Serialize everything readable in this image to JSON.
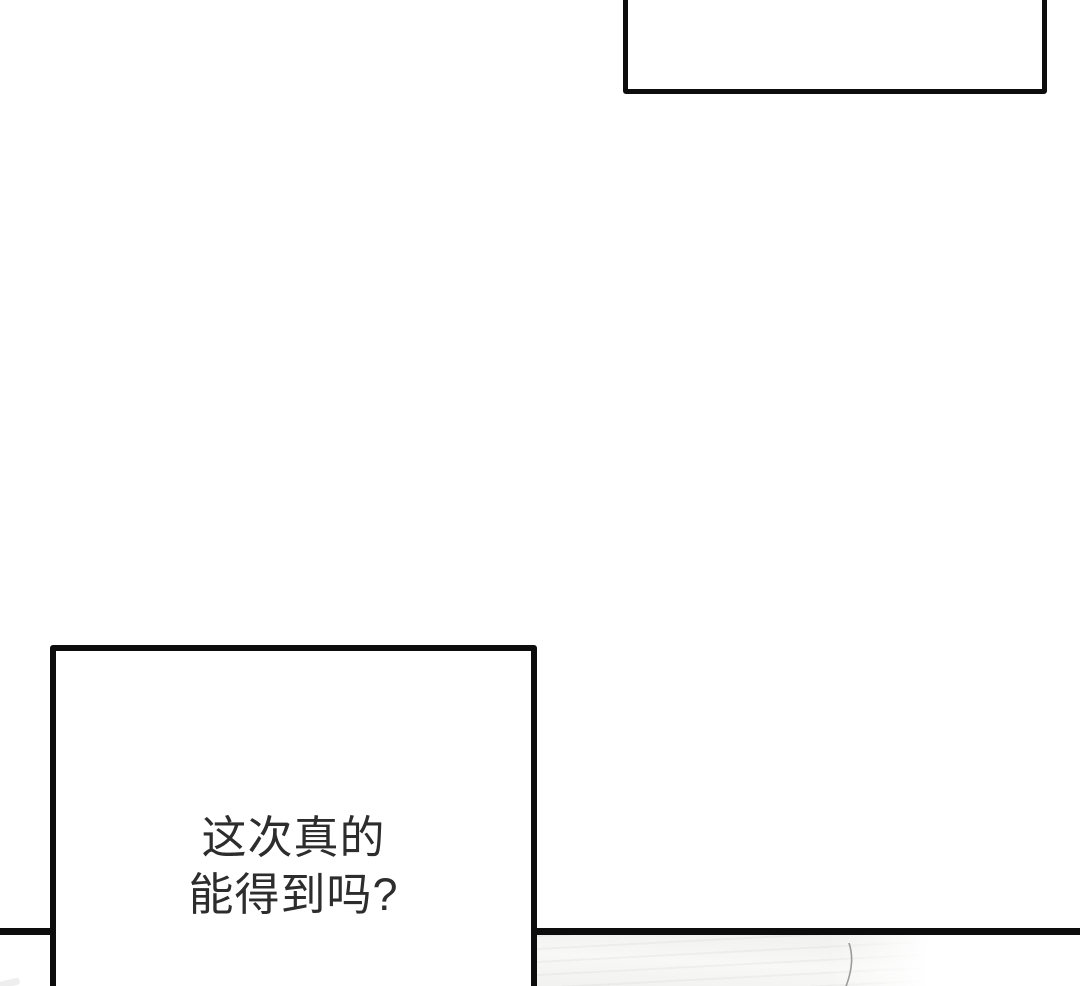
{
  "comic": {
    "background_color": "#ffffff",
    "ink_color": "#0d0d0d",
    "dialog_text_color": "#2d2d2d",
    "bubbles": {
      "top_right": {
        "text": ""
      },
      "bottom_left": {
        "lines": [
          "这次真的",
          "能得到吗?"
        ]
      }
    }
  }
}
